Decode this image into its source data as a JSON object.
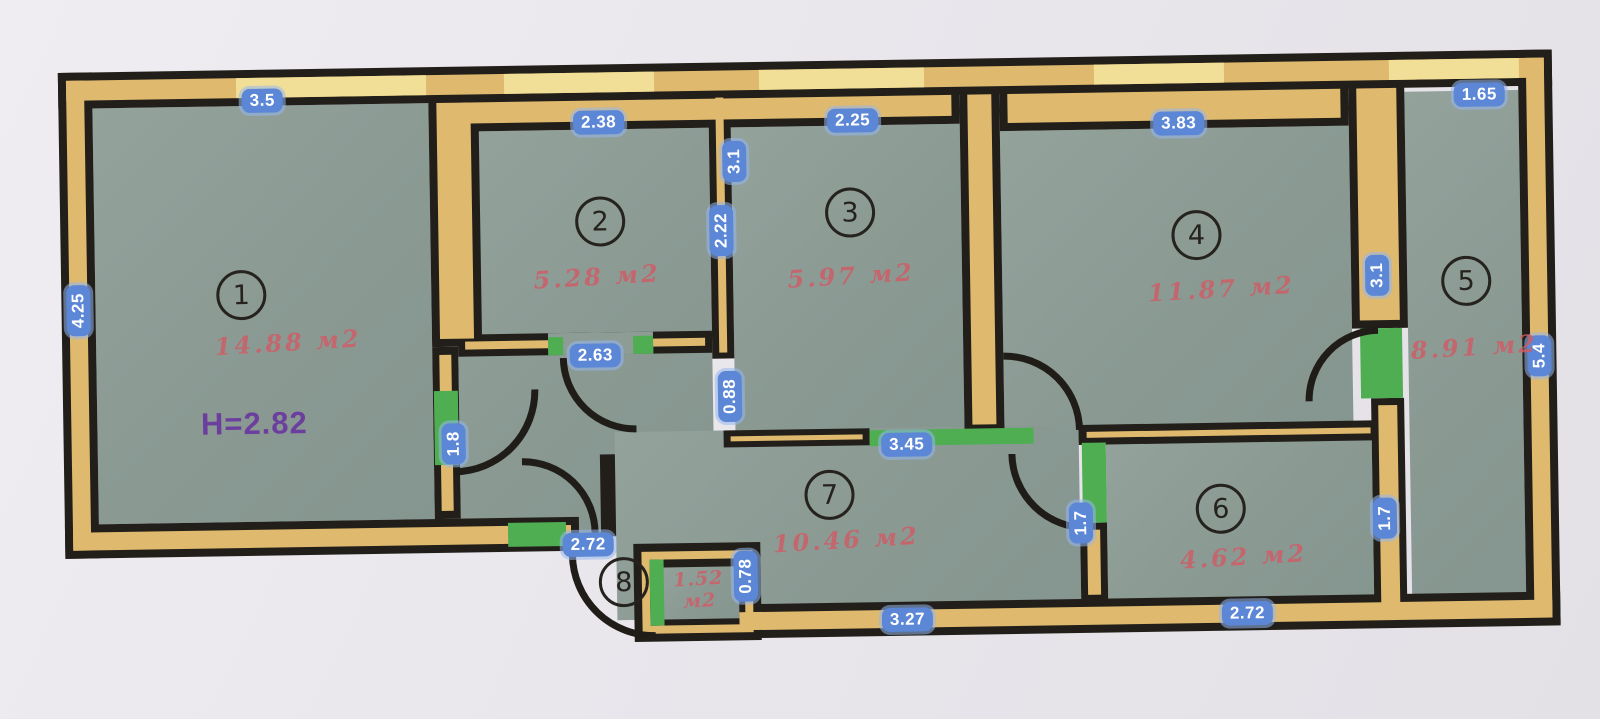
{
  "height_label": "H=2.82",
  "rooms": [
    {
      "number": "1",
      "area": "14.88 м2"
    },
    {
      "number": "2",
      "area": "5.28 м2"
    },
    {
      "number": "3",
      "area": "5.97 м2"
    },
    {
      "number": "4",
      "area": "11.87 м2"
    },
    {
      "number": "5",
      "area": "8.91 м2"
    },
    {
      "number": "6",
      "area": "4.62 м2"
    },
    {
      "number": "7",
      "area": "10.46 м2"
    },
    {
      "number": "8",
      "area_top": "1.52",
      "area_bottom": "м2"
    }
  ],
  "dims": {
    "room1_top": "3.5",
    "room1_left": "4.25",
    "room2_top": "2.38",
    "wall23_upper": "3.1",
    "wall23_lower": "2.22",
    "room3_top": "2.25",
    "room4_top": "3.83",
    "room5_top": "1.65",
    "room5_left": "3.1",
    "room5_right": "5.4",
    "hall_door": "2.63",
    "hall_right_opening": "0.88",
    "room1_door": "1.8",
    "hall_bottom": "2.72",
    "room7_top_opening": "3.45",
    "room8_right": "0.78",
    "room7_bottom": "3.27",
    "room6_left": "1.7",
    "room6_right": "1.7",
    "room6_bottom": "2.72"
  },
  "colors": {
    "paper": "#eae8ec",
    "floor": "#8d9c95",
    "wall_line": "#221f1a",
    "wall_fill": "#dfba6e",
    "window_fill": "#f2df97",
    "door_green": "#4fae52",
    "badge_blue": "#5b87d6",
    "area_red": "#d05c66",
    "height_purple": "#6c3f9f"
  }
}
